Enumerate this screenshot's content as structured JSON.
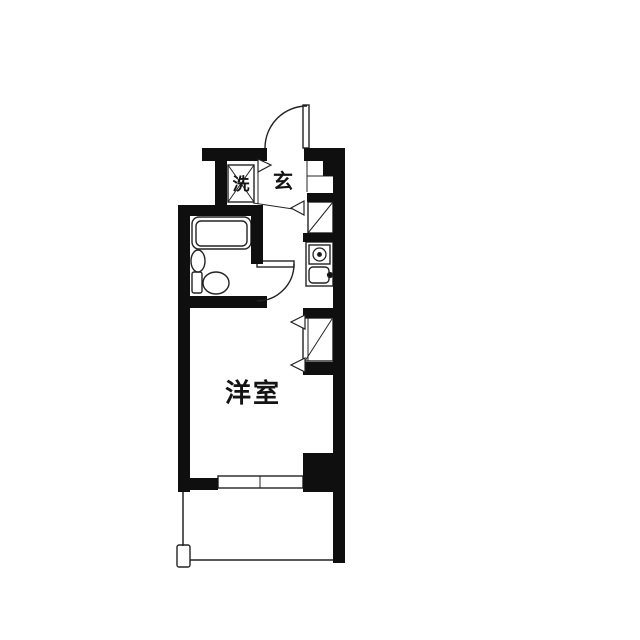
{
  "plan": {
    "background": "#ffffff",
    "ink": "#0f0f0f",
    "thin_stroke": "#232323",
    "labels": [
      {
        "text": "洗",
        "x": 241,
        "y": 185,
        "size": 17,
        "spacing": 0,
        "name": "label-laundry"
      },
      {
        "text": "玄",
        "x": 283,
        "y": 181,
        "size": 20,
        "spacing": 0,
        "name": "label-entrance"
      },
      {
        "text": "洋室",
        "x": 253,
        "y": 394,
        "size": 26,
        "spacing": 2,
        "name": "label-western-room"
      }
    ],
    "walls": [
      [
        202,
        148,
        65,
        13,
        "wall-top-left"
      ],
      [
        304,
        148,
        41,
        13,
        "wall-top-right"
      ],
      [
        323,
        158,
        22,
        18,
        "wall-pillar-entry"
      ],
      [
        333,
        158,
        12,
        405,
        "wall-right"
      ],
      [
        215,
        158,
        12,
        49,
        "wall-laundry-left"
      ],
      [
        178,
        205,
        85,
        11,
        "wall-bath-top"
      ],
      [
        178,
        205,
        12,
        287,
        "wall-left"
      ],
      [
        251,
        214,
        12,
        50,
        "wall-bath-right"
      ],
      [
        178,
        296,
        89,
        12,
        "wall-bath-bottom"
      ],
      [
        307,
        193,
        26,
        9,
        "wall-shoe-closet-top"
      ],
      [
        303,
        233,
        30,
        9,
        "wall-shoe-closet-bottom"
      ],
      [
        303,
        308,
        30,
        10,
        "wall-closet-top"
      ],
      [
        303,
        362,
        30,
        13,
        "wall-closet-bottom"
      ],
      [
        303,
        453,
        42,
        39,
        "wall-bottom-right-block"
      ],
      [
        190,
        478,
        28,
        12,
        "wall-bottom-left"
      ]
    ],
    "thin_rects": [
      [
        228,
        165,
        26,
        37,
        0,
        "washing-machine-box"
      ],
      [
        308,
        202,
        25,
        31,
        0,
        "shoe-closet"
      ],
      [
        303,
        318,
        30,
        43,
        0,
        "closet"
      ],
      [
        306,
        242,
        27,
        44,
        0,
        "kitchen-unit"
      ],
      [
        309,
        245,
        21,
        19,
        0,
        "stove-box"
      ],
      [
        309,
        267,
        20,
        16,
        4,
        "sink"
      ],
      [
        218,
        476,
        85,
        12,
        0,
        "sliding-window"
      ],
      [
        177,
        545,
        13,
        22,
        2,
        "balcony-post"
      ],
      [
        192,
        217,
        59,
        32,
        7,
        "bathtub-outer"
      ],
      [
        196,
        221,
        51,
        25,
        5,
        "bathtub-inner"
      ],
      [
        192,
        272,
        10,
        21,
        2,
        "toilet-tank"
      ],
      [
        303,
        105,
        6,
        43,
        "0",
        "entrance-door-leaf"
      ],
      [
        257,
        261,
        37,
        6,
        "0",
        "bathroom-door-leaf"
      ]
    ],
    "lines": [
      [
        258,
        160,
        258,
        204,
        1,
        "genkan-divider"
      ],
      [
        253,
        203,
        293,
        209,
        1,
        "genkan-step-line"
      ],
      [
        307,
        158,
        307,
        192,
        1,
        "entry-pocket-left"
      ],
      [
        307,
        176,
        333,
        176,
        1,
        "entry-pocket-divider"
      ],
      [
        228,
        165,
        254,
        202,
        1,
        "washing-cross-1"
      ],
      [
        254,
        165,
        228,
        202,
        1,
        "washing-cross-2"
      ],
      [
        308,
        233,
        333,
        202,
        1,
        "shoe-closet-diagonal"
      ],
      [
        305,
        361,
        332,
        319,
        1,
        "closet-diagonal"
      ],
      [
        308,
        318,
        308,
        361,
        1,
        "closet-door-line"
      ],
      [
        260,
        476,
        260,
        488,
        1,
        "window-divider"
      ],
      [
        183,
        492,
        183,
        546,
        1.5,
        "balcony-left-line"
      ],
      [
        190,
        560,
        333,
        560,
        1.5,
        "balcony-bottom-line"
      ],
      [
        192,
        256,
        204,
        256,
        1,
        "washbasin-detail"
      ]
    ],
    "arcs": [
      {
        "d": "M 265 148 A 42 42 0 0 1 307 106",
        "name": "entrance-door-arc"
      },
      {
        "d": "M 294 264 A 37 37 0 0 1 257 301",
        "name": "bathroom-door-arc"
      }
    ],
    "triangles": [
      [
        [
          258,
          159
        ],
        [
          271,
          165
        ],
        [
          258,
          172
        ],
        "marker-laundry-door"
      ],
      [
        [
          304,
          201
        ],
        [
          291,
          208
        ],
        [
          304,
          215
        ],
        "marker-shoe-closet-door"
      ],
      [
        [
          305,
          315
        ],
        [
          291,
          322
        ],
        [
          305,
          329
        ],
        "marker-closet-door-top"
      ],
      [
        [
          305,
          358
        ],
        [
          291,
          365
        ],
        [
          305,
          372
        ],
        "marker-closet-door-bottom"
      ]
    ],
    "circles": [
      [
        319.5,
        254.5,
        6.5,
        "none",
        "stove-burner"
      ],
      [
        319.5,
        254.5,
        1.8,
        "ink",
        "stove-burner-dot"
      ],
      [
        330,
        275,
        2.5,
        "ink",
        "sink-faucet"
      ]
    ],
    "ellipses": [
      [
        198,
        261,
        7,
        11,
        "washbasin"
      ],
      [
        216,
        283,
        13,
        11,
        "toilet-bowl"
      ]
    ]
  }
}
